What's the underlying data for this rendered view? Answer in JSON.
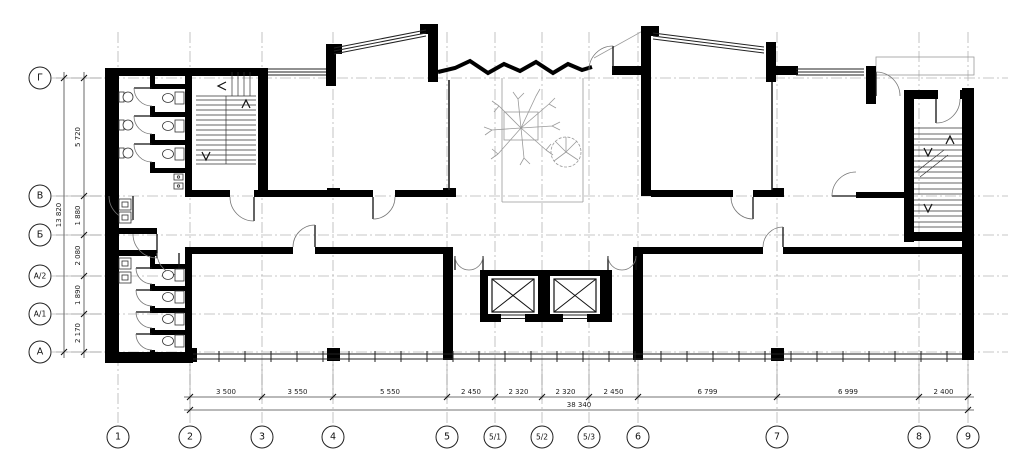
{
  "palette": {
    "background": "#ffffff",
    "wall": "#000000",
    "grid": "#b5b5b5",
    "dim_text": "#222222"
  },
  "column_axes": [
    "1",
    "2",
    "3",
    "4",
    "5",
    "5/1",
    "5/2",
    "5/3",
    "6",
    "7",
    "8",
    "9"
  ],
  "row_axes": [
    "Г",
    "В",
    "Б",
    "А/2",
    "А/1",
    "А"
  ],
  "bottom_dimensions": {
    "segments": [
      "3 500",
      "3 550",
      "5 550",
      "2 450",
      "2 320",
      "2 320",
      "2 450",
      "6 799",
      "6 999",
      "2 400"
    ],
    "total": "38 340"
  },
  "left_dimensions": {
    "segments": [
      "5 720",
      "1 880",
      "2 080",
      "1 890",
      "2 170"
    ],
    "total": "13 820"
  }
}
